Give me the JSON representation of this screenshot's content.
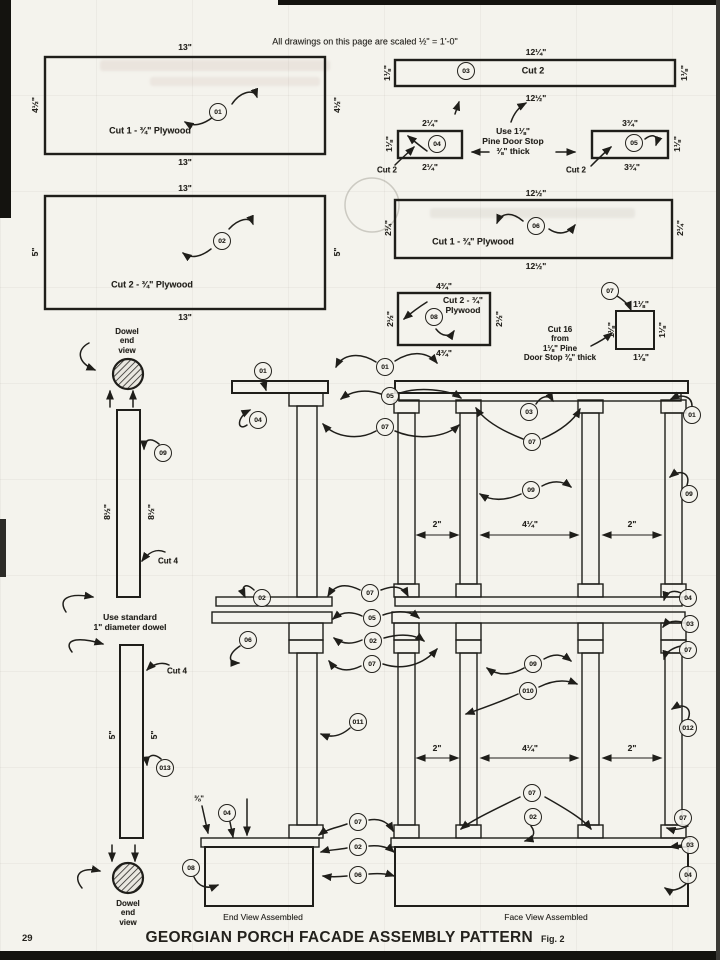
{
  "page": {
    "scale_note": "All drawings on this page are scaled ½\" = 1'-0\"",
    "title": "GEORGIAN PORCH FACADE ASSEMBLY PATTERN",
    "figure": "Fig. 2",
    "page_number": "29",
    "end_view_caption": "End View Assembled",
    "face_view_caption": "Face View Assembled"
  },
  "colors": {
    "ink": "#1f1e1a",
    "paper": "#f4f3ed"
  },
  "labels": [
    {
      "t": "13\"",
      "x": 185,
      "y": 47
    },
    {
      "t": "13\"",
      "x": 185,
      "y": 162
    },
    {
      "t": "4½\"",
      "x": 35,
      "y": 105,
      "r": -90
    },
    {
      "t": "4½\"",
      "x": 337,
      "y": 105,
      "r": -90
    },
    {
      "t": "Cut 1 - ¾\" Plywood",
      "x": 150,
      "y": 131,
      "s": 9,
      "n": "piece-01-cut-note"
    },
    {
      "t": "13\"",
      "x": 185,
      "y": 188
    },
    {
      "t": "13\"",
      "x": 185,
      "y": 317
    },
    {
      "t": "5\"",
      "x": 35,
      "y": 252,
      "r": -90
    },
    {
      "t": "5\"",
      "x": 337,
      "y": 252,
      "r": -90
    },
    {
      "t": "Cut 2 - ¾\" Plywood",
      "x": 152,
      "y": 285,
      "s": 9,
      "n": "piece-02-cut-note"
    },
    {
      "t": "12¼\"",
      "x": 536,
      "y": 52
    },
    {
      "t": "12½\"",
      "x": 536,
      "y": 98
    },
    {
      "t": "1⅛\"",
      "x": 387,
      "y": 73,
      "r": -90
    },
    {
      "t": "1⅛\"",
      "x": 684,
      "y": 73,
      "r": -90
    },
    {
      "t": "Cut 2",
      "x": 533,
      "y": 71,
      "s": 9,
      "n": "piece-03-cut-note"
    },
    {
      "t": "2¼\"",
      "x": 430,
      "y": 123
    },
    {
      "t": "2¼\"",
      "x": 430,
      "y": 167
    },
    {
      "t": "1⅛\"",
      "x": 389,
      "y": 144,
      "r": -90
    },
    {
      "t": "Cut 2",
      "x": 387,
      "y": 170,
      "s": 8,
      "n": "piece-04-cut-note"
    },
    {
      "t": "Use 1⅛\"\nPine Door Stop\n⅜\" thick",
      "x": 513,
      "y": 141,
      "s": 8.5,
      "n": "door-stop-note"
    },
    {
      "t": "3¾\"",
      "x": 630,
      "y": 123
    },
    {
      "t": "3¾\"",
      "x": 632,
      "y": 167
    },
    {
      "t": "1⅛\"",
      "x": 677,
      "y": 144,
      "r": -90
    },
    {
      "t": "Cut 2",
      "x": 576,
      "y": 170,
      "s": 8,
      "n": "piece-05-cut-note"
    },
    {
      "t": "12½\"",
      "x": 536,
      "y": 193
    },
    {
      "t": "12½\"",
      "x": 536,
      "y": 266
    },
    {
      "t": "2¼\"",
      "x": 388,
      "y": 228,
      "r": -90
    },
    {
      "t": "2¼\"",
      "x": 680,
      "y": 228,
      "r": -90
    },
    {
      "t": "Cut 1 - ¾\" Plywood",
      "x": 473,
      "y": 242,
      "s": 9,
      "n": "piece-06-cut-note"
    },
    {
      "t": "4¾\"",
      "x": 444,
      "y": 286
    },
    {
      "t": "4¾\"",
      "x": 444,
      "y": 353
    },
    {
      "t": "2½\"",
      "x": 390,
      "y": 319,
      "r": -90
    },
    {
      "t": "2½\"",
      "x": 499,
      "y": 319,
      "r": -90
    },
    {
      "t": "Cut 2 - ¾\"\nPlywood",
      "x": 463,
      "y": 305,
      "s": 8.5,
      "n": "piece-08-cut-note"
    },
    {
      "t": "1⅛\"",
      "x": 641,
      "y": 304
    },
    {
      "t": "1⅛\"",
      "x": 611,
      "y": 330,
      "r": -90
    },
    {
      "t": "1⅛\"",
      "x": 662,
      "y": 330,
      "r": -90
    },
    {
      "t": "1⅛\"",
      "x": 641,
      "y": 357
    },
    {
      "t": "Cut 16\nfrom\n1⅛\" Pine\nDoor Stop ⅜\" thick",
      "x": 560,
      "y": 344,
      "s": 8,
      "n": "piece-07-cut-note"
    },
    {
      "t": "Dowel\nend\nview",
      "x": 127,
      "y": 341,
      "s": 8,
      "n": "dowel-end-view-label"
    },
    {
      "t": "8½\"",
      "x": 107,
      "y": 512,
      "r": -90
    },
    {
      "t": "8½\"",
      "x": 151,
      "y": 512,
      "r": -90
    },
    {
      "t": "Cut 4",
      "x": 168,
      "y": 561,
      "s": 8,
      "n": "piece-09-cut-note"
    },
    {
      "t": "Use standard\n1\" diameter dowel",
      "x": 130,
      "y": 622,
      "s": 8.5,
      "n": "dowel-note"
    },
    {
      "t": "Cut 4",
      "x": 177,
      "y": 671,
      "s": 8,
      "n": "piece-013-cut-note"
    },
    {
      "t": "5\"",
      "x": 112,
      "y": 735,
      "r": -90
    },
    {
      "t": "5\"",
      "x": 154,
      "y": 735,
      "r": -90
    },
    {
      "t": "Dowel\nend\nview",
      "x": 128,
      "y": 913,
      "s": 8,
      "n": "dowel-end-view-label"
    },
    {
      "t": "2\"",
      "x": 437,
      "y": 524
    },
    {
      "t": "4¼\"",
      "x": 530,
      "y": 524
    },
    {
      "t": "2\"",
      "x": 632,
      "y": 524
    },
    {
      "t": "2\"",
      "x": 437,
      "y": 748
    },
    {
      "t": "4¼\"",
      "x": 530,
      "y": 748
    },
    {
      "t": "2\"",
      "x": 632,
      "y": 748
    },
    {
      "t": "⅜\"",
      "x": 199,
      "y": 799,
      "s": 7.5
    }
  ],
  "circles": [
    {
      "t": "01",
      "x": 218,
      "y": 112
    },
    {
      "t": "02",
      "x": 222,
      "y": 241
    },
    {
      "t": "03",
      "x": 466,
      "y": 71
    },
    {
      "t": "04",
      "x": 437,
      "y": 144
    },
    {
      "t": "05",
      "x": 634,
      "y": 143
    },
    {
      "t": "06",
      "x": 536,
      "y": 226
    },
    {
      "t": "07",
      "x": 610,
      "y": 291
    },
    {
      "t": "08",
      "x": 434,
      "y": 317
    },
    {
      "t": "09",
      "x": 163,
      "y": 453
    },
    {
      "t": "013",
      "x": 165,
      "y": 768
    },
    {
      "t": "01",
      "x": 263,
      "y": 371
    },
    {
      "t": "04",
      "x": 258,
      "y": 420
    },
    {
      "t": "01",
      "x": 385,
      "y": 367
    },
    {
      "t": "05",
      "x": 390,
      "y": 396
    },
    {
      "t": "07",
      "x": 385,
      "y": 427
    },
    {
      "t": "03",
      "x": 529,
      "y": 412
    },
    {
      "t": "07",
      "x": 532,
      "y": 442
    },
    {
      "t": "01",
      "x": 692,
      "y": 415
    },
    {
      "t": "09",
      "x": 531,
      "y": 490
    },
    {
      "t": "09",
      "x": 689,
      "y": 494
    },
    {
      "t": "07",
      "x": 370,
      "y": 593
    },
    {
      "t": "05",
      "x": 372,
      "y": 618
    },
    {
      "t": "02",
      "x": 373,
      "y": 641
    },
    {
      "t": "07",
      "x": 372,
      "y": 664
    },
    {
      "t": "02",
      "x": 262,
      "y": 598
    },
    {
      "t": "06",
      "x": 248,
      "y": 640
    },
    {
      "t": "04",
      "x": 688,
      "y": 598
    },
    {
      "t": "03",
      "x": 690,
      "y": 624
    },
    {
      "t": "07",
      "x": 688,
      "y": 650
    },
    {
      "t": "09",
      "x": 533,
      "y": 664
    },
    {
      "t": "010",
      "x": 528,
      "y": 691
    },
    {
      "t": "011",
      "x": 358,
      "y": 722
    },
    {
      "t": "012",
      "x": 688,
      "y": 728
    },
    {
      "t": "07",
      "x": 532,
      "y": 793
    },
    {
      "t": "02",
      "x": 533,
      "y": 817
    },
    {
      "t": "07",
      "x": 358,
      "y": 822
    },
    {
      "t": "02",
      "x": 358,
      "y": 847
    },
    {
      "t": "06",
      "x": 358,
      "y": 875
    },
    {
      "t": "04",
      "x": 227,
      "y": 813
    },
    {
      "t": "08",
      "x": 191,
      "y": 868
    },
    {
      "t": "07",
      "x": 683,
      "y": 818
    },
    {
      "t": "03",
      "x": 690,
      "y": 845
    },
    {
      "t": "04",
      "x": 688,
      "y": 875
    }
  ]
}
